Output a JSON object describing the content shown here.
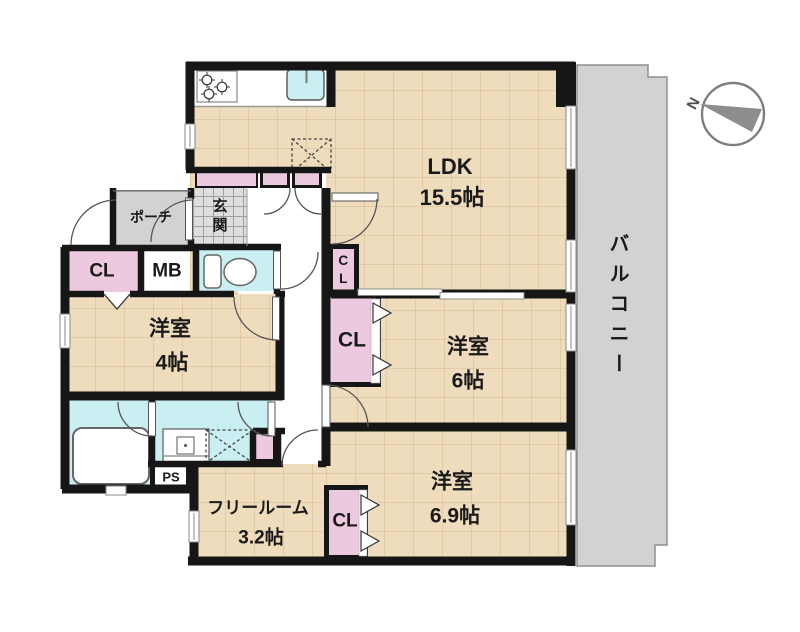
{
  "plan": {
    "rooms": {
      "ldk": {
        "label": "LDK",
        "size": "15.5帖"
      },
      "bedroom6": {
        "label": "洋室",
        "size": "6帖"
      },
      "bedroom6_9": {
        "label": "洋室",
        "size": "6.9帖"
      },
      "bedroom4": {
        "label": "洋室",
        "size": "4帖"
      },
      "free_room": {
        "label": "フリールーム",
        "size": "3.2帖"
      },
      "balcony": {
        "label": "バルコニー"
      },
      "porch": {
        "label": "ポーチ"
      },
      "entrance": {
        "label": "玄関"
      }
    },
    "storage": {
      "entrance_closet": {
        "label": "CL"
      },
      "meter_box": {
        "label": "MB"
      },
      "hall_closet": {
        "label": "CL"
      },
      "bedroom6_closet": {
        "label": "CL"
      },
      "bedroom6_9_closet": {
        "label": "CL"
      },
      "pipe_space": {
        "label": "PS"
      }
    },
    "compass": {
      "north_label": "N"
    },
    "colors": {
      "wall": "#161616",
      "floor": "#eedcbc",
      "closet": "#ecc9de",
      "wet_area": "#c9eff2",
      "balcony": "#d2d2d2",
      "tile": "#dedede"
    }
  }
}
